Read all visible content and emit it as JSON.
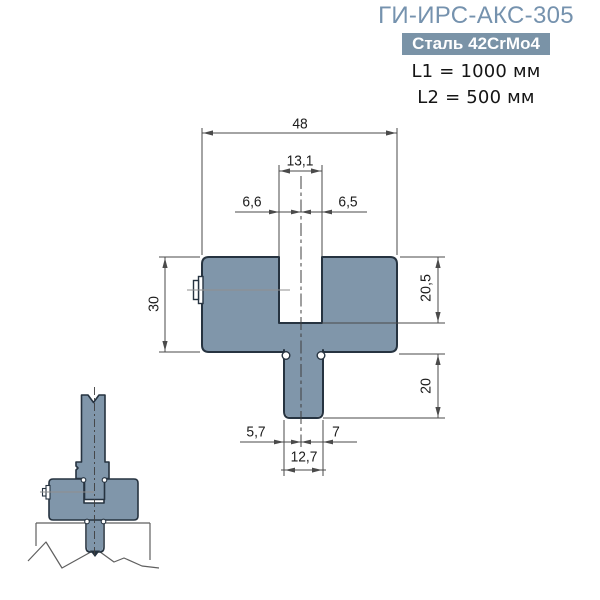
{
  "header": {
    "title": "ГИ-ИРС-АКС-305",
    "material_badge": "Сталь 42CrMo4",
    "l1": "L1 = 1000 мм",
    "l2": "L2 = 500 мм"
  },
  "drawing": {
    "dim_total_width": "48",
    "dim_slot_width": "13,1",
    "dim_center_to_slot_left": "6,6",
    "dim_center_to_slot_right": "6,5",
    "dim_body_height": "30",
    "dim_slot_depth": "20,5",
    "dim_tang_height": "20",
    "dim_tang_left": "5,7",
    "dim_tang_right": "7",
    "dim_tang_width": "12,7"
  },
  "colors": {
    "title_text": "#7592ae",
    "badge_bg": "#7a93a7",
    "badge_text": "#ffffff",
    "body_fill": "#8096aa",
    "body_stroke": "#263340",
    "dim_line": "#4a4a4a",
    "dim_text": "#1c1c1c",
    "thin_outline": "#5f5f5f"
  }
}
